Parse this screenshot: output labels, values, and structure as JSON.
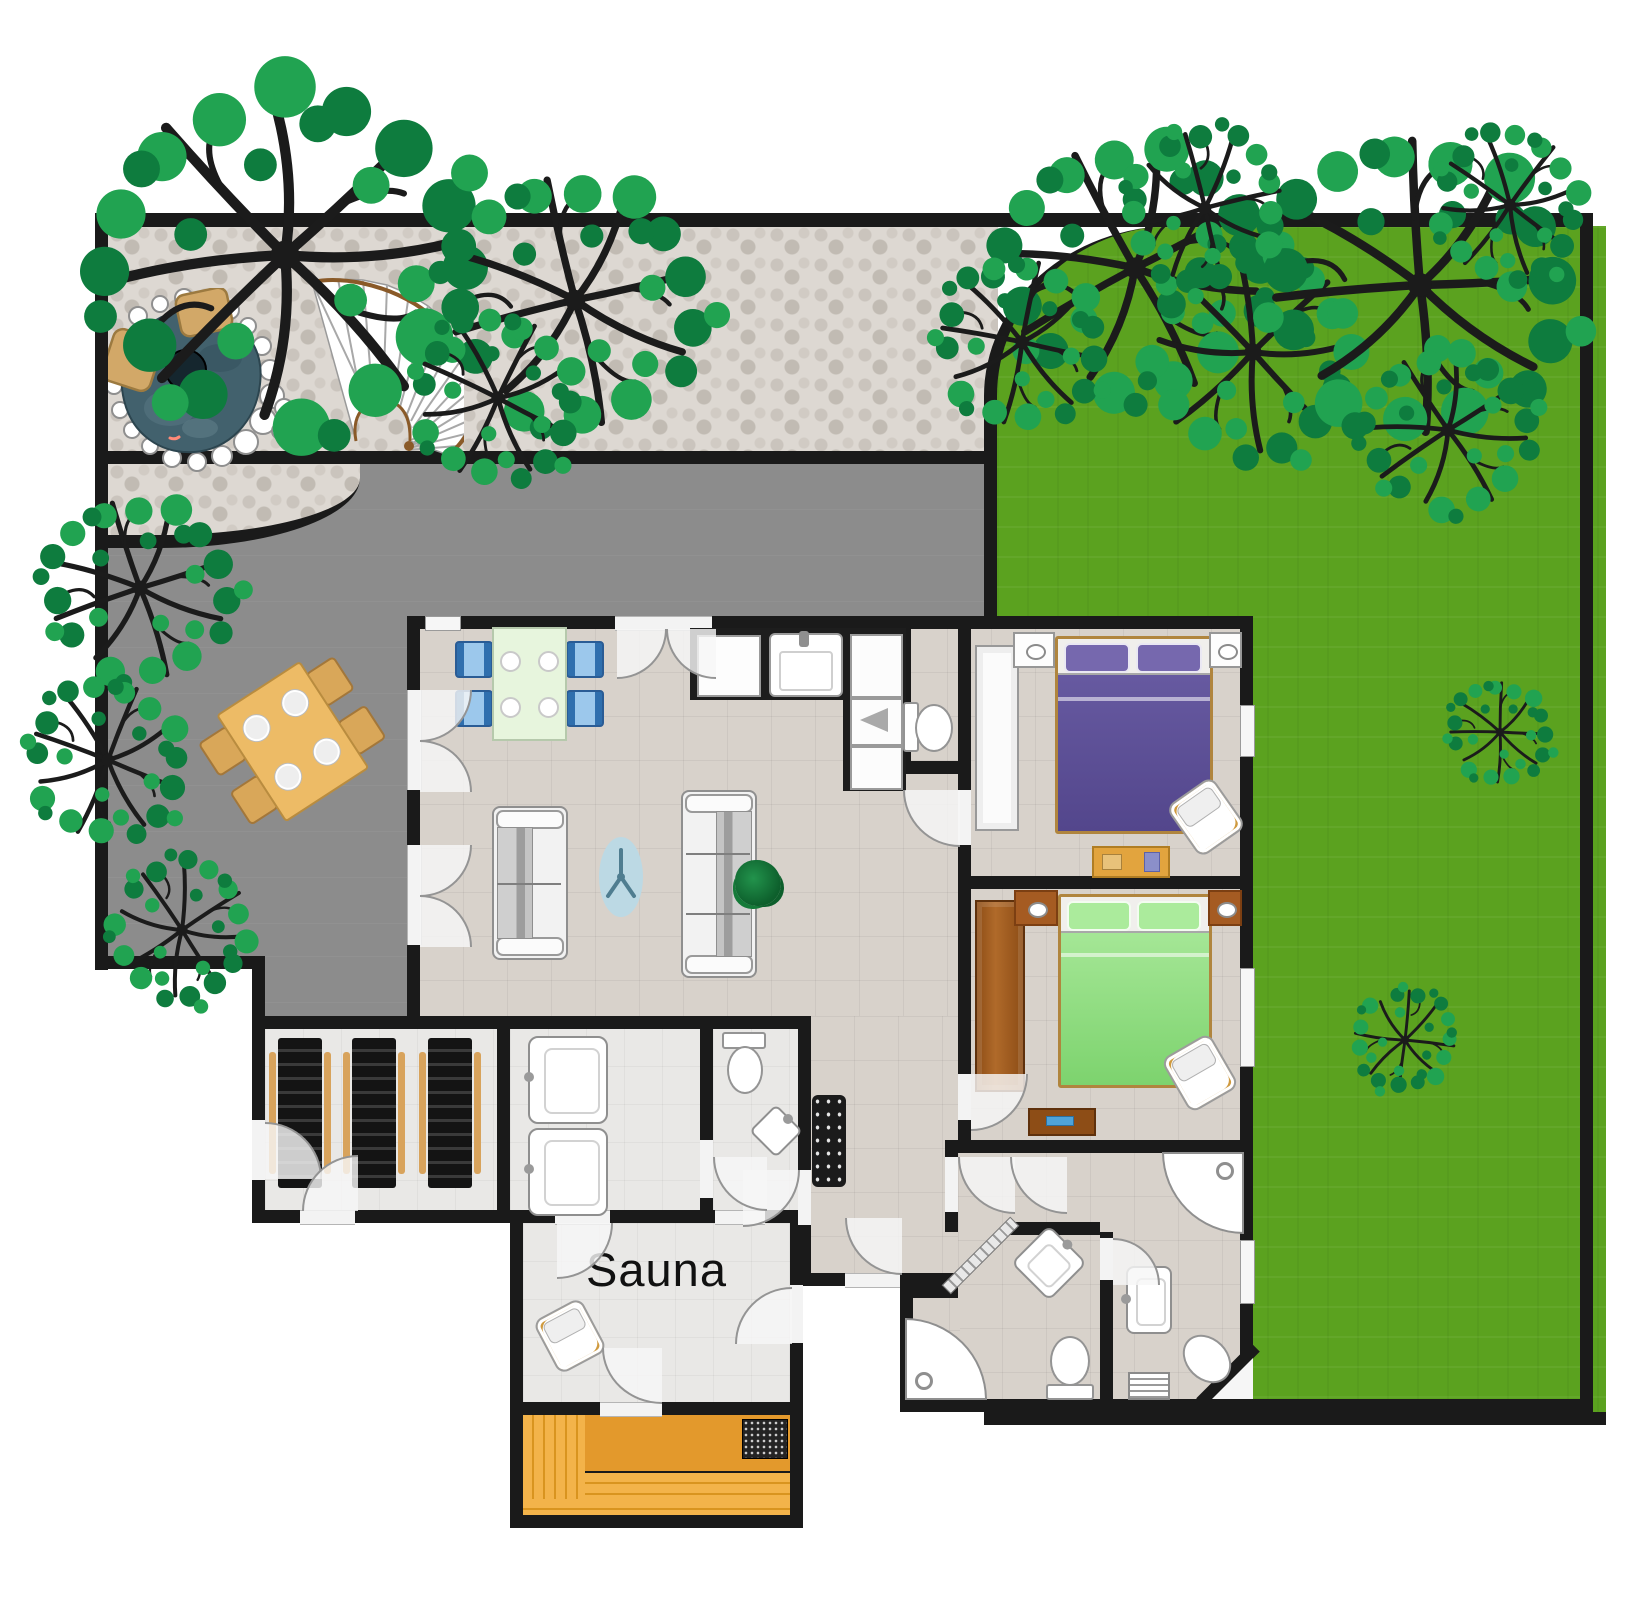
{
  "labels": {
    "sauna": "Sauna"
  },
  "colors": {
    "wall": "#1a1a1a",
    "lawn": "#5ba21f",
    "patio": "#8c8c8c",
    "gravel": "#ddd8d2",
    "floor": "#d8d2cb",
    "wet_floor": "#e9e8e6",
    "wood": "#efa93f",
    "wood_dark": "#e3992c",
    "purple_bed": "#5a4c92",
    "purple_pillow": "#7668ae",
    "green_bed": "#93e184",
    "green_pillow": "#abeb9c",
    "water": "#42616d",
    "tree_green": "#21a351",
    "tree_green_dark": "#0e7c3e",
    "counter": "#1d1d1d",
    "lounger": "#1b1b1b",
    "chair_blue": "#5b9bd5",
    "table_green": "#e7f5dd",
    "outdoor_wood": "#edbb66",
    "door_arc": "#949494"
  }
}
